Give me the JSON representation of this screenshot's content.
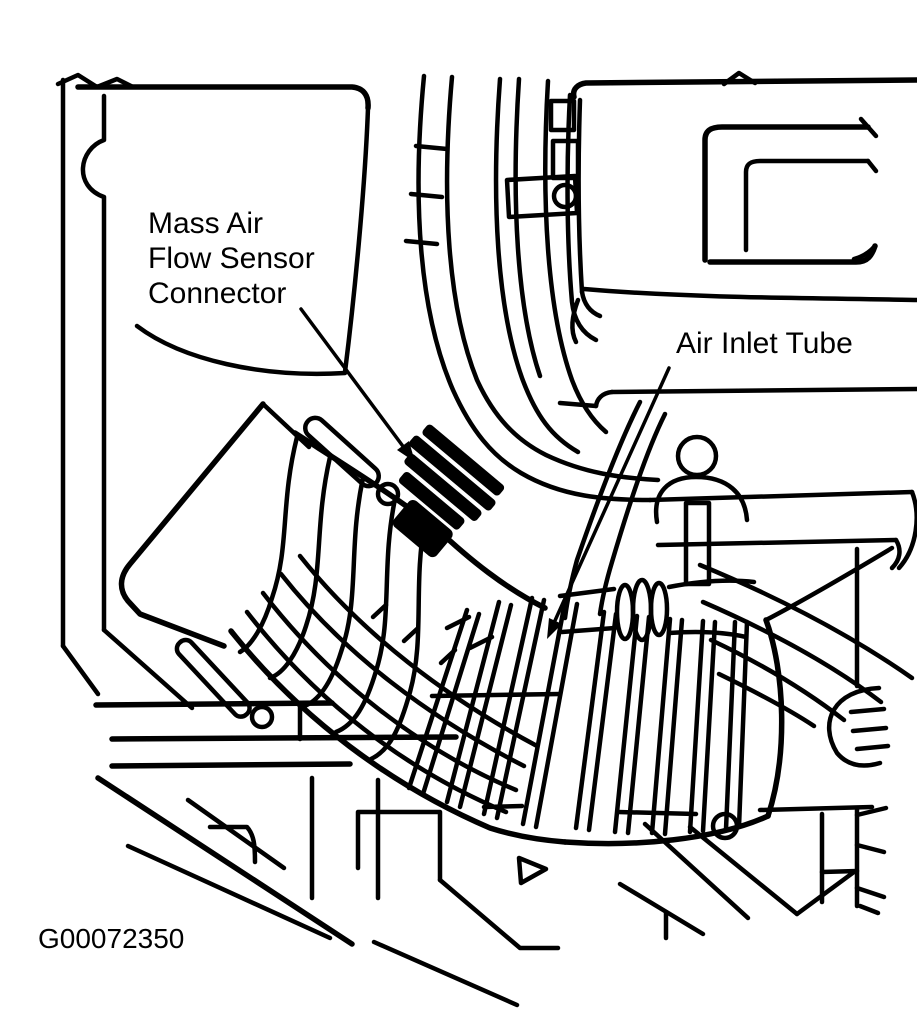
{
  "figure": {
    "background_color": "#ffffff",
    "line_color": "#000000",
    "labels": {
      "maf_line1": "Mass Air",
      "maf_line2": "Flow Sensor",
      "maf_line3": "Connector",
      "air_inlet": "Air Inlet Tube"
    },
    "callouts": [
      {
        "label": "Mass Air Flow Sensor Connector",
        "target": "maf-connector-block"
      },
      {
        "label": "Air Inlet Tube",
        "target": "air-duct-bellows"
      }
    ],
    "figure_code": "G00072350"
  }
}
